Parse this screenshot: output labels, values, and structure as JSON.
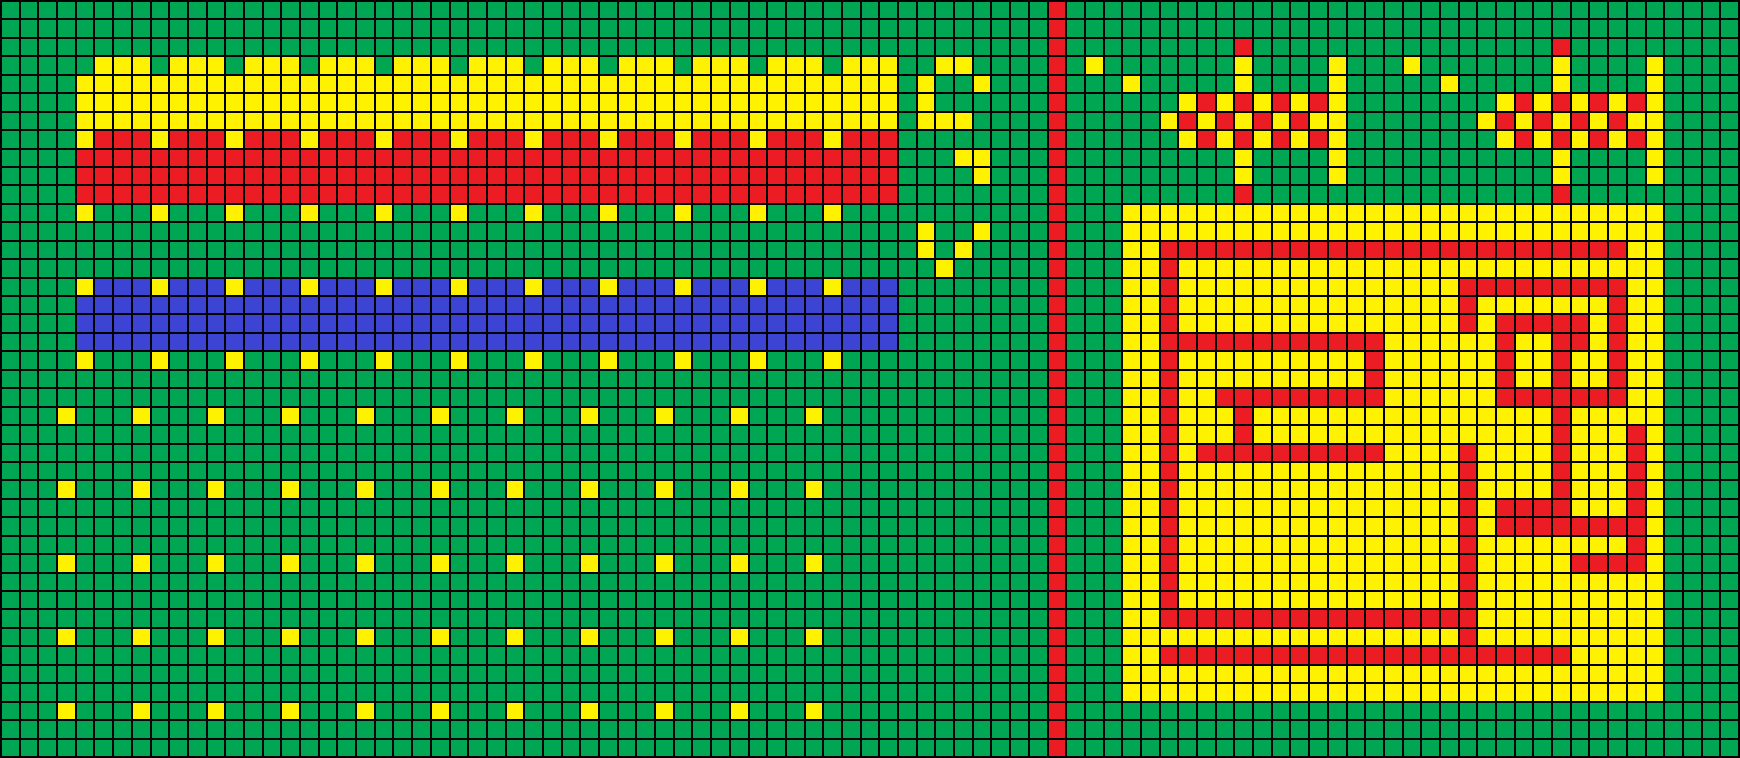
{
  "canvas": {
    "cols": 93,
    "rows": 41,
    "palette": {
      "G": "#00a651",
      "Y": "#fff200",
      "R": "#ec1c24",
      "B": "#3c44d4",
      "gridline": "#000000"
    },
    "grid_rows": [
      "GGGGGGGGGGGGGGGGGGGGGGGGGGGGGGGGGGGGGGGGGGGGGGGGGGGGGGGGRGGGGGGGGGGGGGGGGGGGGGGGGGGGGGGGGGGGG",
      "GGGGGGGGGGGGGGGGGGGGGGGGGGGGGGGGGGGGGGGGGGGGGGGGGGGGGGGGRGGGGGGGGGGGGGGGGGGGGGGGGGGGGGGGGGGGG",
      "GGGGGGGGGGGGGGGGGGGGGGGGGGGGGGGGGGGGGGGGGGGGGGGGGGGGGGGGRGGGGGGGGGRGGGGGGGGGGGGGGGGRGGGGGGGGG",
      "GGGGGYYYGYYYGYYYGYYYGYYYGYYYGYYYGYYYGYYYGYYYGYYYGGYYGGGGRGYGGGGGGGYGGGGYGGGYGGGGGGGYGGGGYGGGG",
      "GGGGYYYYYYYYYYYYYYYYYYYYYYYYYYYYYYYYYYYYYYYYYYYYGYGGYGGGRGGGYGGGGGYGGGGYGGGGGYGGGGGYGGGGYGGGG",
      "GGGGYYYYYYYYYYYYYYYYYYYYYYYYYYYYYYYYYYYYYYYYYYYYGYGGGGGGRGGGGGGYRYRYRYRYGGGGGGGGYRYRYRYRYGGGG",
      "GGGGYYYYYYYYYYYYYYYYYYYYYYYYYYYYYYYYYYYYYYYYYYYYGYYYGGGGRGGGGGYRYRYRYRYYGGGGGGGYRYRYRYRYYGGGG",
      "GGGGYRRRYRRRYRRRYRRRYRRRYRRRYRRRYRRRYRRRYRRRYRRRGGGGGGGGRGGGGGGYRYRYRYRYGGGGGGGGYRYRYRYRYGGGG",
      "GGGGRRRRRRRRRRRRRRRRRRRRRRRRRRRRRRRRRRRRRRRRRRRRGGGYYGGGRGGGGGGGGGYGGGGYGGGGGGGGGGGYGGGGYGGGG",
      "GGGGRRRRRRRRRRRRRRRRRRRRRRRRRRRRRRRRRRRRRRRRRRRRGGGGYGGGRGGGGGGGGGYGGGGYGGGGGGGGGGGYGGGGYGGGG",
      "GGGGRRRRRRRRRRRRRRRRRRRRRRRRRRRRRRRRRRRRRRRRRRRRGGGGGGGGRGGGGGGGGGRGGGGGGGGGGGGGGGGRGGGGGGGGG",
      "GGGGYGGGYGGGYGGGYGGGYGGGYGGGYGGGYGGGYGGGYGGGYGGGGGGGGGGGRGGGYYYYYYYYYYYYYYYYYYYYYYYYYYYYYGGGG",
      "GGGGGGGGGGGGGGGGGGGGGGGGGGGGGGGGGGGGGGGGGGGGGGGGGYGGYGGGRGGGYYYYYYYYYYYYYYYYYYYYYYYYYYYYYGGGG",
      "GGGGGGGGGGGGGGGGGGGGGGGGGGGGGGGGGGGGGGGGGGGGGGGGGYGYGGGGRGGGYYRRRRRRRRRRRRRRRRRRRRRRRRRYYGGGG",
      "GGGGGGGGGGGGGGGGGGGGGGGGGGGGGGGGGGGGGGGGGGGGGGGGGGYGGGGGRGGGYYRYYYYYYYYYYYYYYYYYYYYYYYYYYGGGG",
      "GGGGYBBBYBBBYBBBYBBBYBBBYBBBYBBBYBBBYBBBYBBBYBBBGGGGGGGGRGGGYYRYYYYYYYYYYYYYYYRRRRRRRRRYYGGGG",
      "GGGGBBBBBBBBBBBBBBBBBBBBBBBBBBBBBBBBBBBBBBBBBBBBGGGGGGGGRGGGYYRYYYYYYYYYYYYYYYRYYYYYYYRYYGGGG",
      "GGGGBBBBBBBBBBBBBBBBBBBBBBBBBBBBBBBBBBBBBBBBBBBBGGGGGGGGRGGGYYRYYYYYYYYYYYYYYYRYRRRRRYRYYGGGG",
      "GGGGBBBBBBBBBBBBBBBBBBBBBBBBBBBBBBBBBBBBBBBBBBBBGGGGGGGGRGGGYYRRRRRRRRRRRRYYYYYYRYYRRYRYYGGGG",
      "GGGGYGGGYGGGYGGGYGGGYGGGYGGGYGGGYGGGYGGGYGGGYGGGGGGGGGGGRGGGYYRYYYYYYYYYYRYYYYYYRYYRYYRYYGGGG",
      "GGGGGGGGGGGGGGGGGGGGGGGGGGGGGGGGGGGGGGGGGGGGGGGGGGGGGGGGRGGGYYRYYYYYYYYYYRYYYYYYRYYRYYRYYGGGG",
      "GGGGGGGGGGGGGGGGGGGGGGGGGGGGGGGGGGGGGGGGGGGGGGGGGGGGGGGGRGGGYYRYYRRRRRRRRRYYYYYYRRRRRRRYYGGGG",
      "GGGYGGGYGGGYGGGYGGGYGGGYGGGYGGGYGGGYGGGYGGGYGGGGGGGGGGGGRGGGYYRYYYRYYYYYYYYYYYYYYYYRYYYYYGGGG",
      "GGGGGGGGGGGGGGGGGGGGGGGGGGGGGGGGGGGGGGGGGGGGGGGGGGGGGGGGRGGGYYRYYYRYYYYYYYYYYYYYYYYRYYYRYGGGG",
      "GGGGGGGGGGGGGGGGGGGGGGGGGGGGGGGGGGGGGGGGGGGGGGGGGGGGGGGGRGGGYYRYRRRRRRRRRRYYYYRYYYYRYYYRYGGGG",
      "GGGGGGGGGGGGGGGGGGGGGGGGGGGGGGGGGGGGGGGGGGGGGGGGGGGGGGGGRGGGYYRYYYYYYYYYYYYYYYRYYYYRYYYRYGGGG",
      "GGGYGGGYGGGYGGGYGGGYGGGYGGGYGGGYGGGYGGGYGGGYGGGGGGGGGGGGRGGGYYRYYYYYYYYYYYYYYYRYYYYRYYYRYGGGG",
      "GGGGGGGGGGGGGGGGGGGGGGGGGGGGGGGGGGGGGGGGGGGGGGGGGGGGGGGGRGGGYYRYYYYYYYYYYYYYYYRYRRRRYYYRYGGGG",
      "GGGGGGGGGGGGGGGGGGGGGGGGGGGGGGGGGGGGGGGGGGGGGGGGGGGGGGGGRGGGYYRYYYYYYYYYYYYYYYRYRRRRRRRRYGGGG",
      "GGGGGGGGGGGGGGGGGGGGGGGGGGGGGGGGGGGGGGGGGGGGGGGGGGGGGGGGRGGGYYRYYYYYYYYYYYYYYYRYYYYYYYYRYGGGG",
      "GGGYGGGYGGGYGGGYGGGYGGGYGGGYGGGYGGGYGGGYGGGYGGGGGGGGGGGGRGGGYYRYYYYYYYYYYYYYYYRYYYYYRRRRYGGGG",
      "GGGGGGGGGGGGGGGGGGGGGGGGGGGGGGGGGGGGGGGGGGGGGGGGGGGGGGGGRGGGYYRYYYYYYYYYYYYYYYRYYYYYYYYYYGGGG",
      "GGGGGGGGGGGGGGGGGGGGGGGGGGGGGGGGGGGGGGGGGGGGGGGGGGGGGGGGRGGGYYRYYYYYYYYYYYYYYYRYYYYYYYYYYGGGG",
      "GGGGGGGGGGGGGGGGGGGGGGGGGGGGGGGGGGGGGGGGGGGGGGGGGGGGGGGGRGGGYYRRRRRRRRRRRRRRRRRYYYYYYYYYYGGGG",
      "GGGYGGGYGGGYGGGYGGGYGGGYGGGYGGGYGGGYGGGYGGGYGGGGGGGGGGGGRGGGYYYYYYYYYYYYYYYYYYRYYYYYYYYYYGGGG",
      "GGGGGGGGGGGGGGGGGGGGGGGGGGGGGGGGGGGGGGGGGGGGGGGGGGGGGGGGRGGGYYRRRRRRRRRRRRRRRRRRRRRRYYYYYGGGG",
      "GGGGGGGGGGGGGGGGGGGGGGGGGGGGGGGGGGGGGGGGGGGGGGGGGGGGGGGGRGGGYYYYYYYYYYYYYYYYYYYYYYYYYYYYYGGGG",
      "GGGGGGGGGGGGGGGGGGGGGGGGGGGGGGGGGGGGGGGGGGGGGGGGGGGGGGGGRGGGYYYYYYYYYYYYYYYYYYYYYYYYYYYYYGGGG",
      "GGGYGGGYGGGYGGGYGGGYGGGYGGGYGGGYGGGYGGGYGGGYGGGGGGGGGGGGRGGGGGGGGGGGGGGGGGGGGGGGGGGGGGGGGGGGG",
      "GGGGGGGGGGGGGGGGGGGGGGGGGGGGGGGGGGGGGGGGGGGGGGGGGGGGGGGGRGGGGGGGGGGGGGGGGGGGGGGGGGGGGGGGGGGGG",
      "GGGGGGGGGGGGGGGGGGGGGGGGGGGGGGGGGGGGGGGGGGGGGGGGGGGGGGGGRGGGGGGGGGGGGGGGGGGGGGGGGGGGGGGGGGGGG"
    ]
  }
}
